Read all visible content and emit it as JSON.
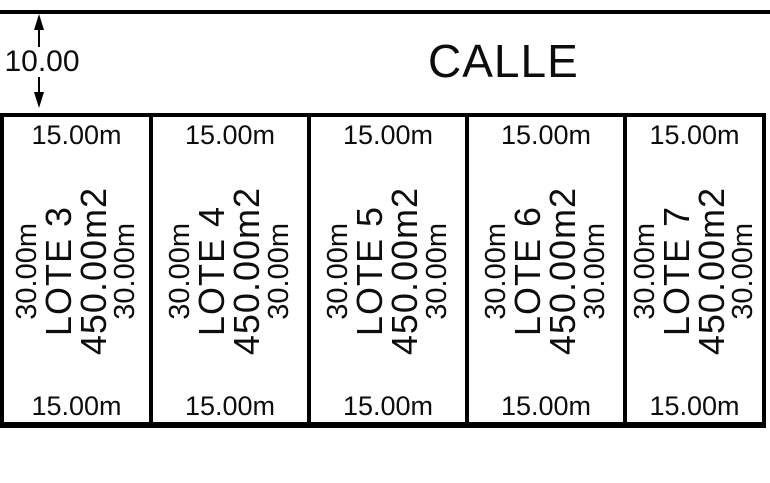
{
  "street": {
    "label": "CALLE",
    "width_value": "10.00"
  },
  "lots": [
    {
      "name": "LOTE 3",
      "area": "450.00m2",
      "front": "15.00m",
      "rear": "15.00m",
      "side_left": "30.00m",
      "side_right": "30.00m"
    },
    {
      "name": "LOTE 4",
      "area": "450.00m2",
      "front": "15.00m",
      "rear": "15.00m",
      "side_left": "30.00m",
      "side_right": "30.00m"
    },
    {
      "name": "LOTE 5",
      "area": "450.00m2",
      "front": "15.00m",
      "rear": "15.00m",
      "side_left": "30.00m",
      "side_right": "30.00m"
    },
    {
      "name": "LOTE 6",
      "area": "450.00m2",
      "front": "15.00m",
      "rear": "15.00m",
      "side_left": "30.00m",
      "side_right": "30.00m"
    },
    {
      "name": "LOTE 7",
      "area": "450.00m2",
      "front": "15.00m",
      "rear": "15.00m",
      "side_left": "30.00m",
      "side_right": "30.00m"
    }
  ],
  "colors": {
    "line": "#000000",
    "text": "#0d0d0d",
    "background": "#ffffff"
  }
}
